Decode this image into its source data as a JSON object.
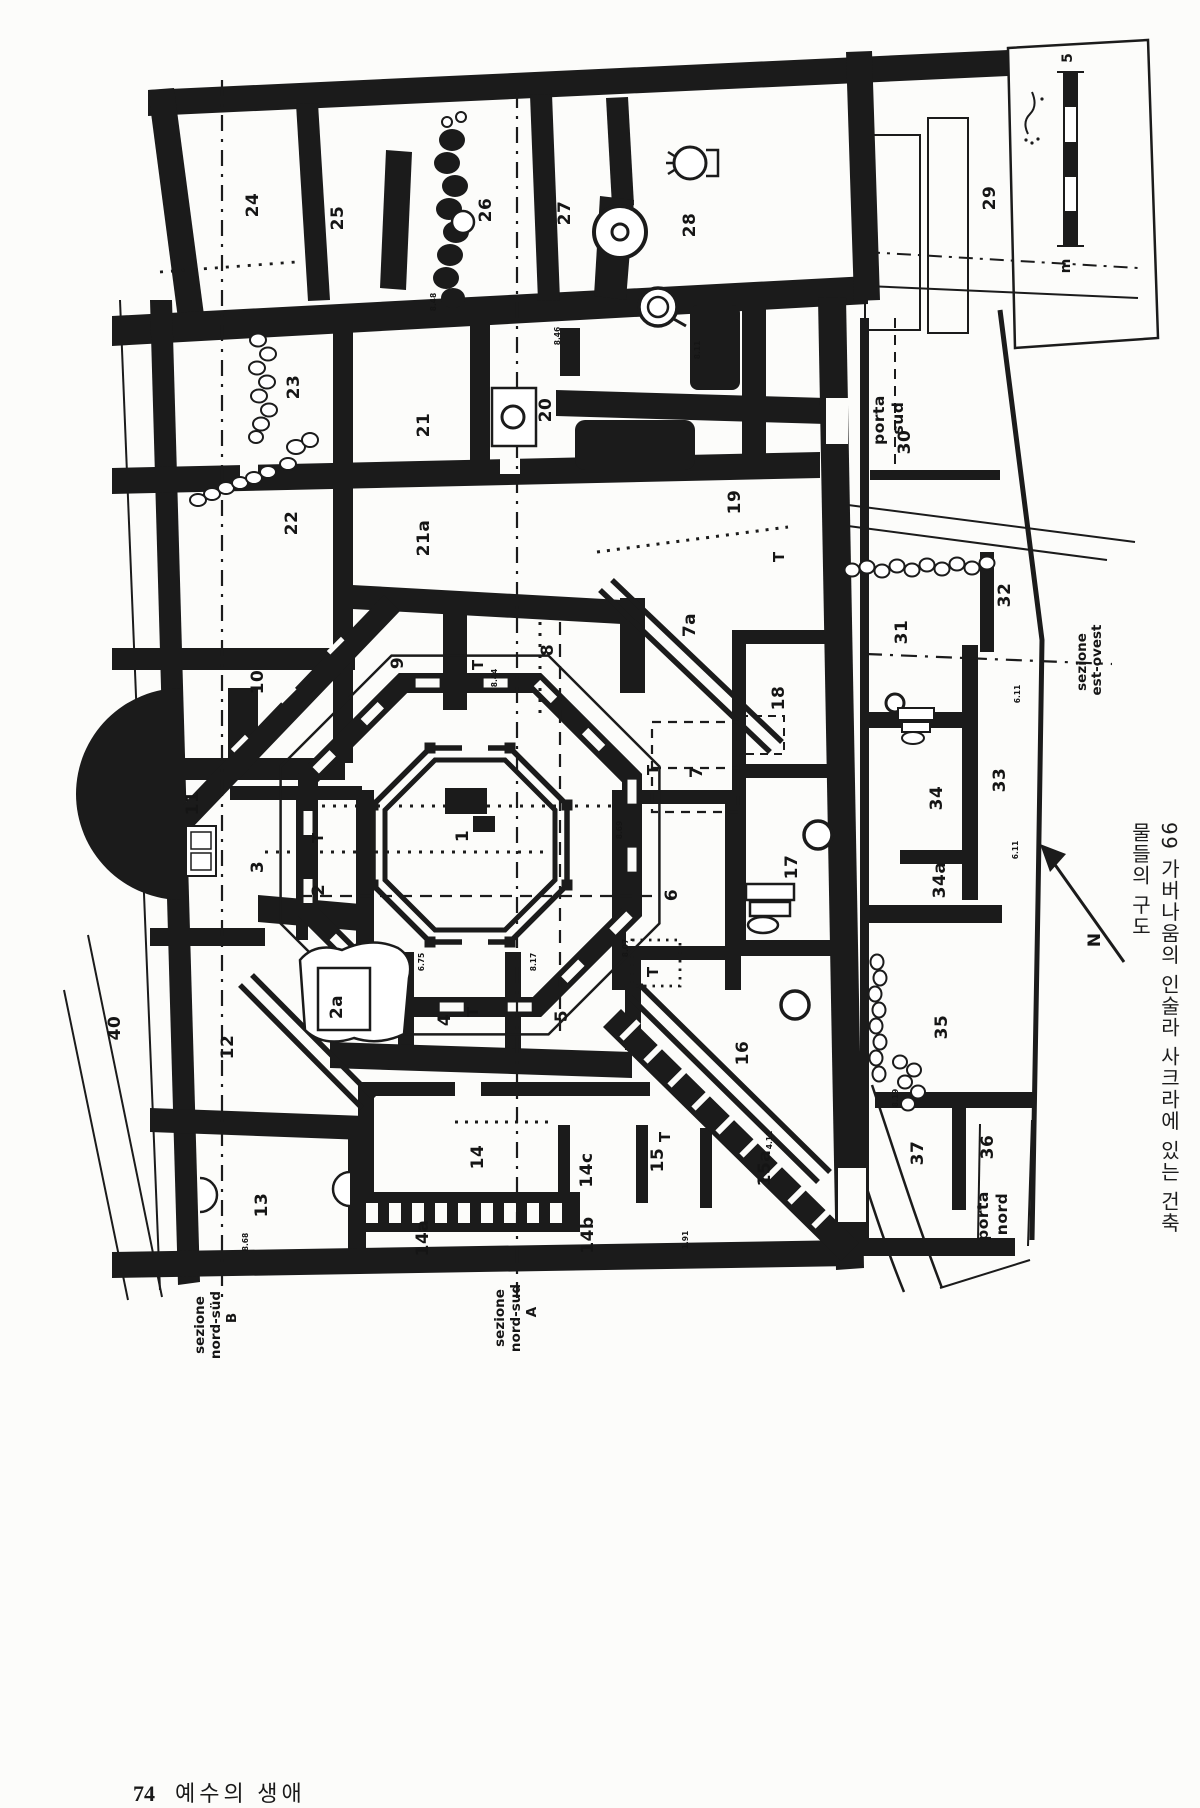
{
  "page": {
    "footer": {
      "page_number": "74",
      "book_title": "예수의 생애"
    },
    "caption": "99 가버나움의 인술라 사크라에 있는 건축물들의 구도"
  },
  "plan": {
    "rooms": [
      {
        "n": "1",
        "x": 468,
        "y": 836
      },
      {
        "n": "2",
        "x": 324,
        "y": 890
      },
      {
        "n": "2a",
        "x": 342,
        "y": 1007
      },
      {
        "n": "3",
        "x": 263,
        "y": 867
      },
      {
        "n": "4",
        "x": 450,
        "y": 1020
      },
      {
        "n": "5",
        "x": 567,
        "y": 1016
      },
      {
        "n": "6",
        "x": 677,
        "y": 895
      },
      {
        "n": "7",
        "x": 702,
        "y": 772
      },
      {
        "n": "7a",
        "x": 695,
        "y": 625
      },
      {
        "n": "8",
        "x": 553,
        "y": 650
      },
      {
        "n": "9",
        "x": 403,
        "y": 663
      },
      {
        "n": "10",
        "x": 263,
        "y": 682
      },
      {
        "n": "11",
        "x": 198,
        "y": 803
      },
      {
        "n": "12",
        "x": 233,
        "y": 1047
      },
      {
        "n": "13",
        "x": 267,
        "y": 1205
      },
      {
        "n": "14",
        "x": 483,
        "y": 1157
      },
      {
        "n": "14a",
        "x": 428,
        "y": 1238
      },
      {
        "n": "14b",
        "x": 593,
        "y": 1235
      },
      {
        "n": "14c",
        "x": 592,
        "y": 1170
      },
      {
        "n": "15",
        "x": 663,
        "y": 1160
      },
      {
        "n": "15a",
        "x": 770,
        "y": 1168
      },
      {
        "n": "16",
        "x": 748,
        "y": 1053
      },
      {
        "n": "17",
        "x": 797,
        "y": 867
      },
      {
        "n": "18",
        "x": 784,
        "y": 698
      },
      {
        "n": "19",
        "x": 740,
        "y": 502
      },
      {
        "n": "20",
        "x": 551,
        "y": 410
      },
      {
        "n": "21",
        "x": 429,
        "y": 425
      },
      {
        "n": "21a",
        "x": 429,
        "y": 538
      },
      {
        "n": "22",
        "x": 297,
        "y": 523
      },
      {
        "n": "23",
        "x": 299,
        "y": 387
      },
      {
        "n": "24",
        "x": 258,
        "y": 205
      },
      {
        "n": "25",
        "x": 343,
        "y": 218
      },
      {
        "n": "26",
        "x": 491,
        "y": 210
      },
      {
        "n": "27",
        "x": 570,
        "y": 213
      },
      {
        "n": "28",
        "x": 695,
        "y": 225
      },
      {
        "n": "29",
        "x": 995,
        "y": 198
      },
      {
        "n": "30",
        "x": 910,
        "y": 442
      },
      {
        "n": "31",
        "x": 907,
        "y": 632
      },
      {
        "n": "32",
        "x": 1010,
        "y": 595
      },
      {
        "n": "33",
        "x": 1005,
        "y": 780
      },
      {
        "n": "34",
        "x": 942,
        "y": 798
      },
      {
        "n": "34a",
        "x": 945,
        "y": 880
      },
      {
        "n": "35",
        "x": 947,
        "y": 1027
      },
      {
        "n": "36",
        "x": 993,
        "y": 1147
      },
      {
        "n": "37",
        "x": 923,
        "y": 1153
      },
      {
        "n": "40",
        "x": 120,
        "y": 1028
      }
    ],
    "t_markers": [
      {
        "t": "T",
        "x": 483,
        "y": 665
      },
      {
        "t": "T",
        "x": 784,
        "y": 557
      },
      {
        "t": "T",
        "x": 658,
        "y": 770
      },
      {
        "t": "T",
        "x": 323,
        "y": 838
      },
      {
        "t": "T",
        "x": 478,
        "y": 1012
      },
      {
        "t": "T",
        "x": 658,
        "y": 972
      },
      {
        "t": "T",
        "x": 670,
        "y": 1137
      }
    ],
    "elevation_marks": [
      {
        "v": "8.48",
        "x": 436,
        "y": 302
      },
      {
        "v": "8.46",
        "x": 560,
        "y": 336
      },
      {
        "v": "8.11",
        "x": 700,
        "y": 350
      },
      {
        "v": "8.44",
        "x": 497,
        "y": 678
      },
      {
        "v": "8.69",
        "x": 622,
        "y": 830
      },
      {
        "v": "6.75",
        "x": 424,
        "y": 962
      },
      {
        "v": "8.17",
        "x": 536,
        "y": 962
      },
      {
        "v": "8.07",
        "x": 628,
        "y": 948
      },
      {
        "v": "6.11",
        "x": 1020,
        "y": 694
      },
      {
        "v": "6.11",
        "x": 1018,
        "y": 850
      },
      {
        "v": "8.19",
        "x": 898,
        "y": 1098
      },
      {
        "v": "4.11",
        "x": 772,
        "y": 1140
      },
      {
        "v": "8.68",
        "x": 248,
        "y": 1242
      },
      {
        "v": "1.91",
        "x": 688,
        "y": 1240
      }
    ],
    "labels": {
      "porta_sud": {
        "lines": [
          "porta",
          "sud"
        ]
      },
      "porta_nord": {
        "lines": [
          "porta",
          "nord"
        ]
      },
      "sezione_est_ovest": {
        "lines": [
          "sezione",
          "est-ovest"
        ]
      },
      "sezione_nord_sud_b": {
        "lines": [
          "sezione",
          "nord-süd",
          "B"
        ]
      },
      "sezione_nord_sud_a": {
        "lines": [
          "sezione",
          "nord-sud",
          "A"
        ]
      },
      "north": "N",
      "outside_area": "40"
    },
    "scale_bar": {
      "top_label": "5",
      "unit_label": "m"
    }
  },
  "colors": {
    "ink": "#1b1b1b",
    "paper": "#fcfcfa"
  }
}
